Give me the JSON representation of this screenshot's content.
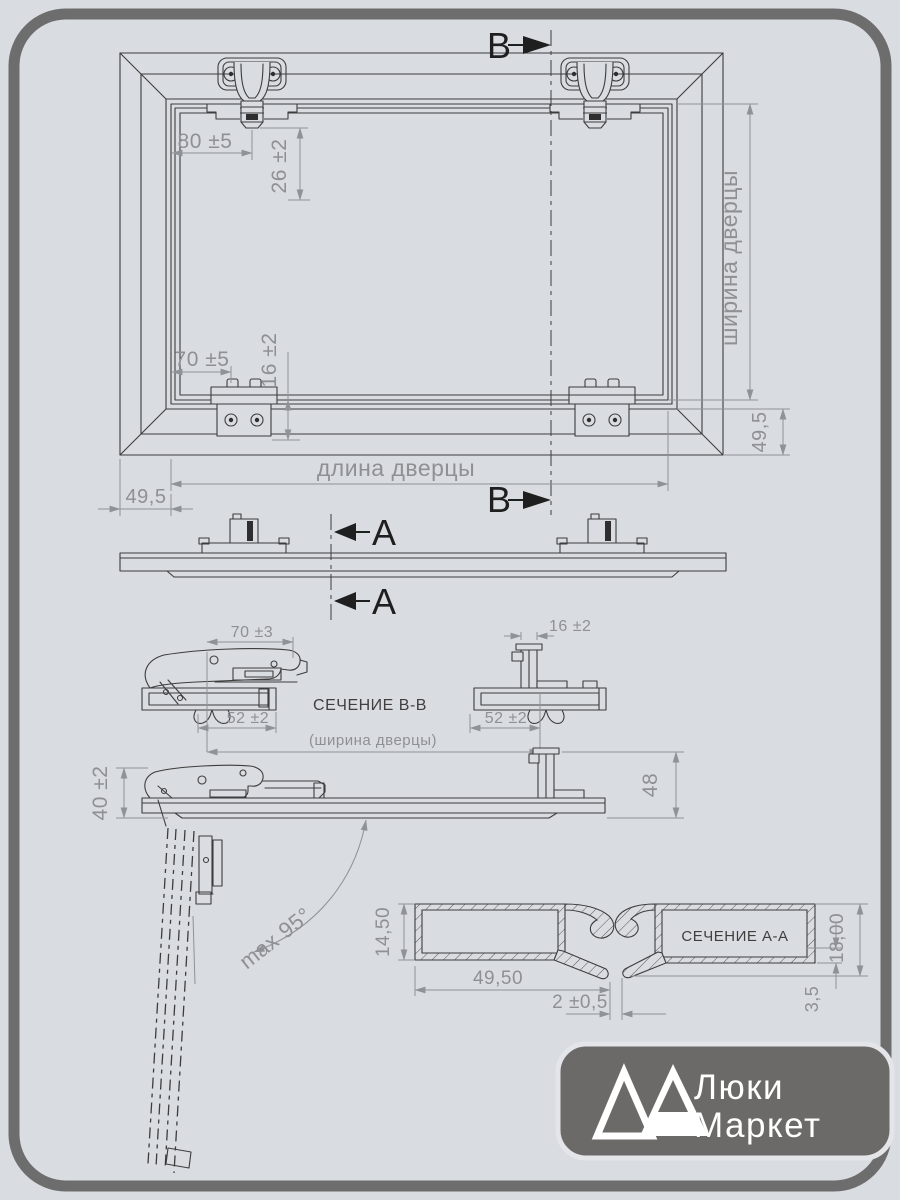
{
  "colors": {
    "background": "#d9dce1",
    "outer_border": "#6d6d6d",
    "drawing_line": "#3d3d3d",
    "dimension_gray": "#8e9094",
    "badge_background": "#6c6969",
    "logo_text": "#ffffff"
  },
  "front_view": {
    "dim_hinge_offset": "80 ±5",
    "dim_hinge_depth": "26 ±2",
    "dim_bracket_offset": "70 ±5",
    "dim_bracket_depth": "16 ±2",
    "door_width_label": "ширина дверцы",
    "door_length_label": "длина дверцы",
    "dim_frame_right": "49,5",
    "dim_frame_bottom": "49,5"
  },
  "section_markers": {
    "b": "B",
    "a": "A"
  },
  "section_bb": {
    "title": "СЕЧЕНИЕ B-B",
    "dim_arm": "70 ±3",
    "dim_plate_left": "52 ±2",
    "dim_bracket": "16 ±2",
    "dim_plate_right": "52 ±2",
    "door_width_ref": "(ширина дверцы)"
  },
  "side_view": {
    "dim_hinge_height": "40 ±2",
    "dim_total_height": "48",
    "max_opening_angle": "max 95°"
  },
  "section_aa": {
    "title": "СЕЧЕНИЕ A-A",
    "dim_profile_height": "14,50",
    "dim_profile_width": "49,50",
    "dim_gap": "2 ±0,5",
    "dim_total_height": "18,00",
    "dim_wall": "3,5"
  },
  "logo": {
    "line1": "Люки",
    "line2": "Маркет"
  }
}
